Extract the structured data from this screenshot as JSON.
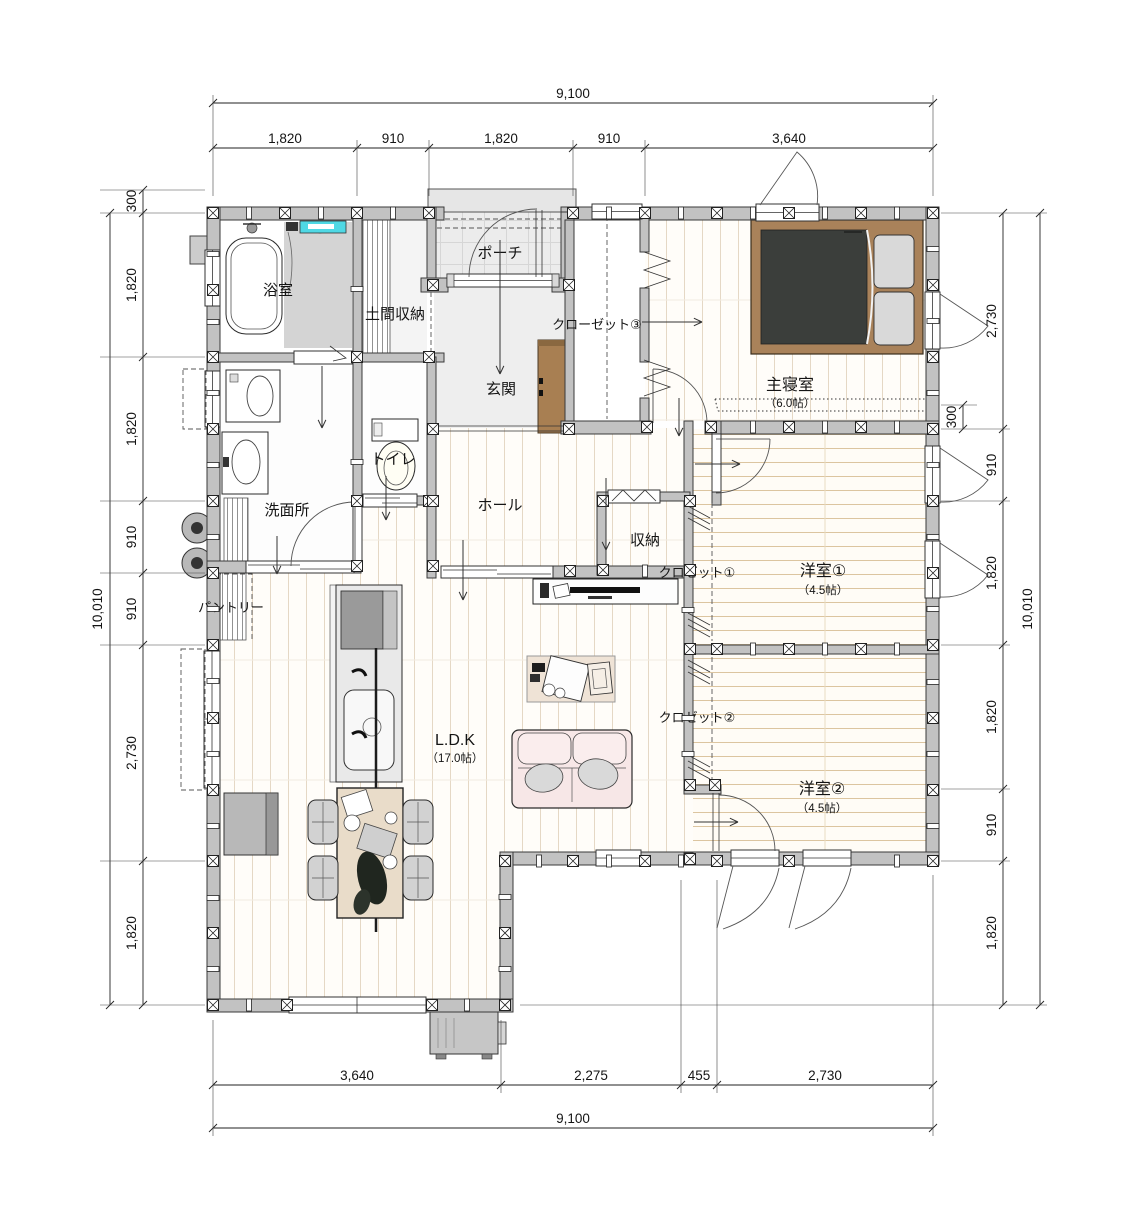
{
  "rooms": {
    "bath": {
      "label": "浴室"
    },
    "doma_storage": {
      "label": "土間収納"
    },
    "porch": {
      "label": "ポーチ"
    },
    "genkan": {
      "label": "玄関"
    },
    "closet3": {
      "label": "クローゼット③"
    },
    "master_bedroom": {
      "label": "主寝室",
      "size": "（6.0帖）"
    },
    "toilet": {
      "label": "トイレ"
    },
    "washroom": {
      "label": "洗面所"
    },
    "hall": {
      "label": "ホール"
    },
    "storage": {
      "label": "収納"
    },
    "closet1": {
      "label": "クロゼット①"
    },
    "western_room1": {
      "label": "洋室①",
      "size": "（4.5帖）"
    },
    "pantry": {
      "label": "パントリー"
    },
    "ldk": {
      "label": "L.D.K",
      "size": "（17.0帖）"
    },
    "closet2": {
      "label": "クロゼット②"
    },
    "western_room2": {
      "label": "洋室②",
      "size": "（4.5帖）"
    }
  },
  "dimensions": {
    "top": {
      "total": "9,100",
      "segments": [
        "1,820",
        "910",
        "1,820",
        "910",
        "3,640"
      ]
    },
    "bottom": {
      "total": "9,100",
      "segments": [
        "3,640",
        "2,275",
        "455",
        "2,730"
      ]
    },
    "left": {
      "total": "10,010",
      "offset": "300",
      "segments": [
        "1,820",
        "1,820",
        "910",
        "910",
        "2,730",
        "1,820"
      ]
    },
    "right": {
      "total": "10,010",
      "offset": "300",
      "segments": [
        "2,730",
        "910",
        "1,820",
        "1,820",
        "910",
        "1,820"
      ]
    }
  },
  "colors": {
    "wall": "#c2c2c2",
    "plank_line_vertical": "#e5d8c5",
    "plank_line_horizontal": "#dcc5a0",
    "bath_accent_cyan": "#4fd8e4",
    "bed_frame_brown": "#a9825a",
    "mattress_dark": "#3b3e3b",
    "shoe_cabinet_brown": "#a87f52",
    "sofa_pink": "#f7e7e7",
    "rug_beige": "#efe3d6",
    "table_beige": "#e9dcc9",
    "hard_floor_gray": "#ececec"
  }
}
